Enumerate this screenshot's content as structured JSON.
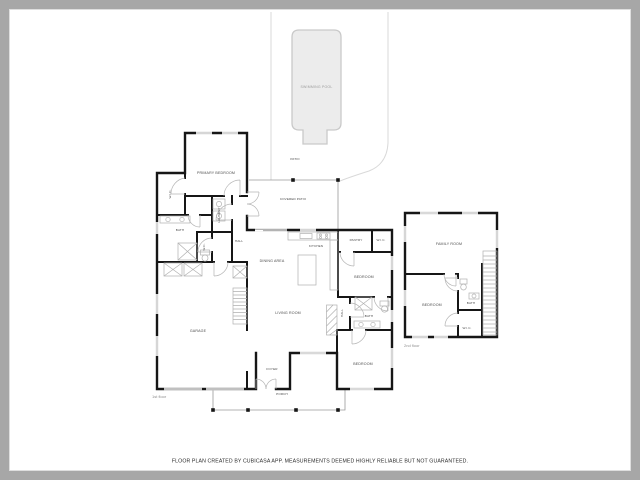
{
  "page": {
    "footer_disclaimer": "FLOOR PLAN CREATED BY CUBICASA APP. MEASUREMENTS DEEMED HIGHLY RELIABLE BUT NOT GUARANTEED."
  },
  "colors": {
    "canvas_background": "#a7a7a7",
    "paper": "#ffffff",
    "walls": "#161616",
    "pool_fill": "#ececec",
    "pool_stroke": "#c9c9c9",
    "room_label": "#4a4a4a",
    "lot_boundary": "#d9d9d9"
  },
  "labels": {
    "swimming_pool": "SWIMMING POOL",
    "patio": "PATIO",
    "covered_patio": "COVERED PATIO",
    "primary_bedroom": "PRIMARY BEDROOM",
    "wic_primary": "W.I.C.",
    "bath_primary": "BATH",
    "wc": "W.C.",
    "laundry": "LAUNDRY",
    "hall_1": "HALL",
    "garage": "GARAGE",
    "dining_area": "DINING AREA",
    "kitchen": "KITCHEN",
    "pantry": "PANTRY",
    "wic_hall": "W.I.C.",
    "bedroom_mid": "BEDROOM",
    "hall_2": "HALL",
    "bath_hall": "BATH",
    "bedroom_lower": "BEDROOM",
    "living_room": "LIVING ROOM",
    "foyer": "FOYER",
    "porch": "PORCH",
    "family_room": "FAMILY ROOM",
    "bedroom_upper": "BEDROOM",
    "bath_upper": "BATH",
    "wic_upper": "W.I.C.",
    "floor_1": "1st floor",
    "floor_2": "2nd floor"
  }
}
